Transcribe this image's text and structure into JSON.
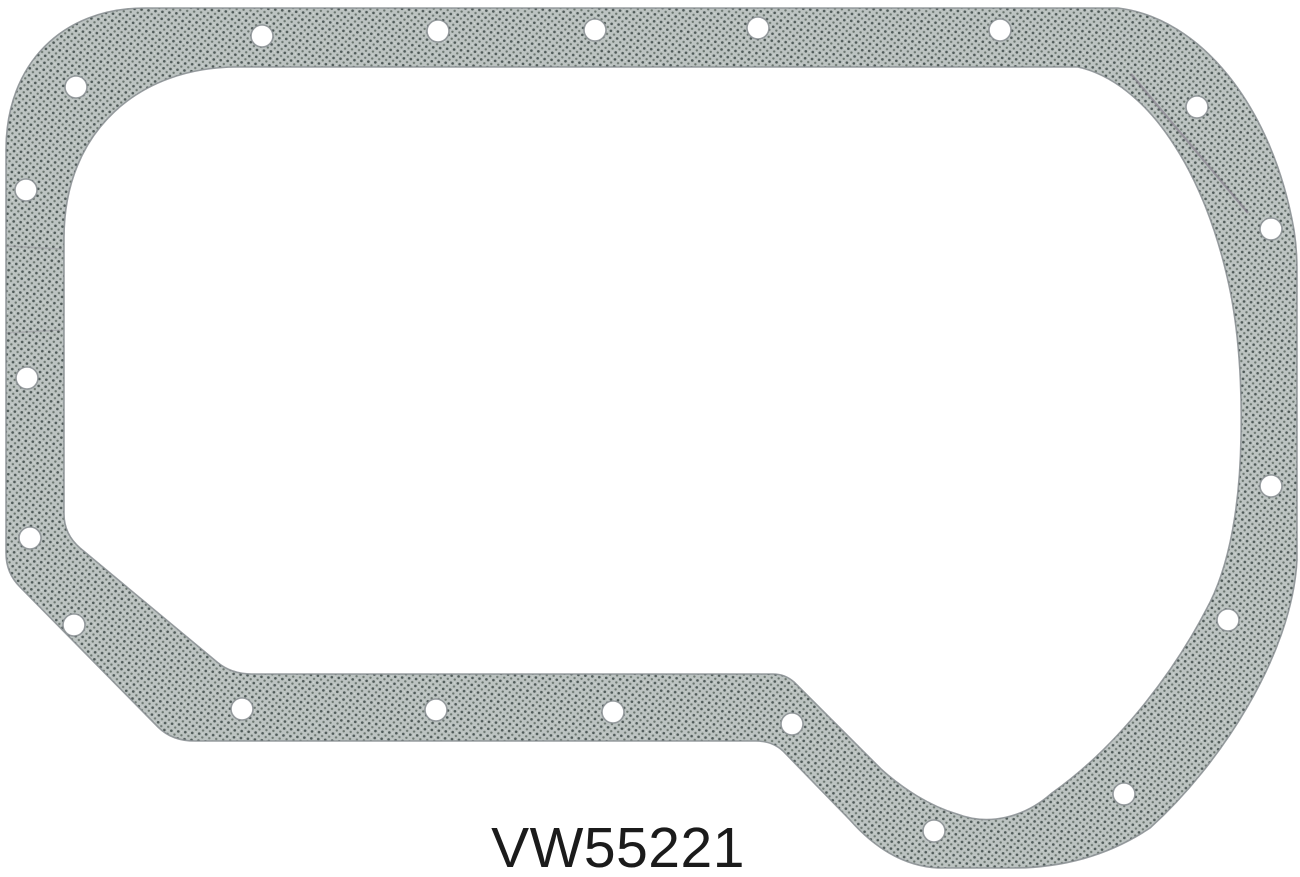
{
  "part_number": "VW55221",
  "product": {
    "item": "oil-pan-gasket",
    "bolt_hole_count": 20
  },
  "colors": {
    "background": "#ffffff",
    "gasket_base": "#bcc3c1",
    "gasket_dot_dark": "#4f5a58",
    "gasket_dot_mid": "#6a756f",
    "gasket_speckle": "#dde1df",
    "gasket_edge": "#878d90",
    "seam": "#6f6678",
    "text": "#1b1b1b"
  }
}
